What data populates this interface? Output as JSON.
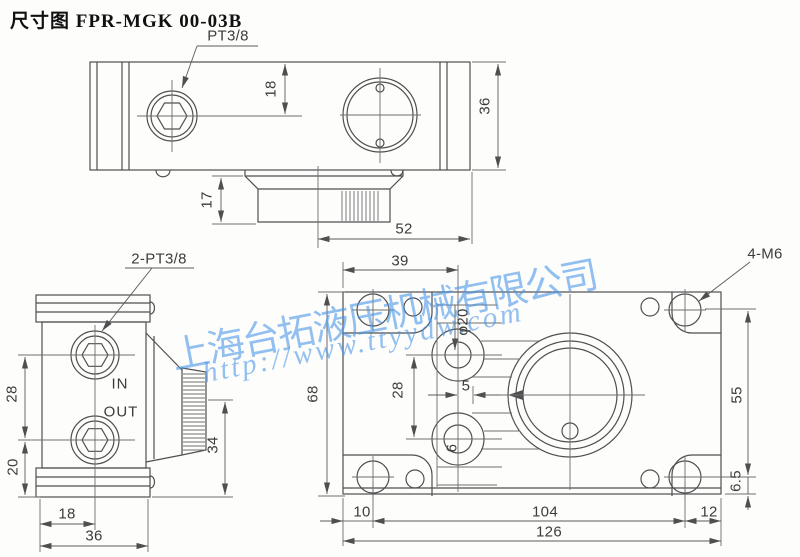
{
  "title": "尺寸图 FPR-MGK 00-03B",
  "watermark": {
    "company": "上海台拓液压机械有限公司",
    "url": "http://www.ttyydw.com",
    "color": "#4a96e8"
  },
  "colors": {
    "line": "#4f4f4f",
    "dim_text": "#3c3c3c",
    "background": "#fdfdfc"
  },
  "top_view": {
    "port_label": "PT3/8",
    "dim_18": "18",
    "dim_36": "36",
    "dim_17": "17",
    "dim_52": "52"
  },
  "side_view": {
    "ports_label": "2-PT3/8",
    "in": "IN",
    "out": "OUT",
    "dim_28": "28",
    "dim_20": "20",
    "dim_18": "18",
    "dim_36": "36",
    "dim_34": "34"
  },
  "front_view": {
    "holes_label": "4-M6",
    "dim_39": "39",
    "dim_68": "68",
    "dim_28": "28",
    "dim_phi20": "φ20",
    "dim_5": "5",
    "dim_6": "6",
    "dim_10": "10",
    "dim_104": "104",
    "dim_126": "126",
    "dim_12": "12",
    "dim_55": "55",
    "dim_6_5": "6.5"
  }
}
